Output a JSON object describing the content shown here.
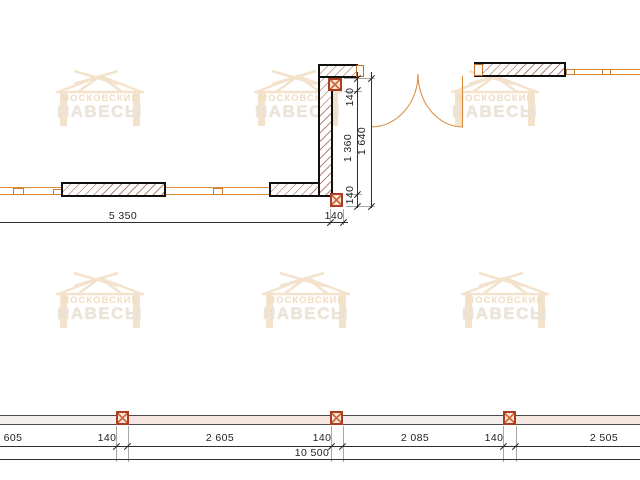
{
  "watermark": {
    "brand_line1": "МОСКОВСКИЕ",
    "brand_line2": "НАВЕСЫ",
    "icon": "gazebo-canopy-roof",
    "color": "#f3e2cc"
  },
  "top_plan": {
    "dim_horizontal": {
      "wall_length": "5 350",
      "post_width": "140"
    },
    "dim_vertical_inner": {
      "top": "140",
      "middle": "1 360",
      "bottom": "140"
    },
    "dim_vertical_outer": {
      "total": "1 640"
    }
  },
  "bottom_plan": {
    "dim_segments": [
      "605",
      "140",
      "2 605",
      "140",
      "2 085",
      "140",
      "2 505"
    ],
    "dim_total": "10 500"
  },
  "symbols": {
    "post_marker": "crossed-square",
    "wall_fill": "diagonal-hatch"
  },
  "colors": {
    "construction_line_orange": "#dd8a35",
    "wall_outline": "#101010",
    "post_marker_red": "#ad3d22",
    "dimension_line": "#2f2f2f",
    "watermark_peach": "#f3e2cc",
    "band_fill_pink": "#f5e6e2"
  }
}
